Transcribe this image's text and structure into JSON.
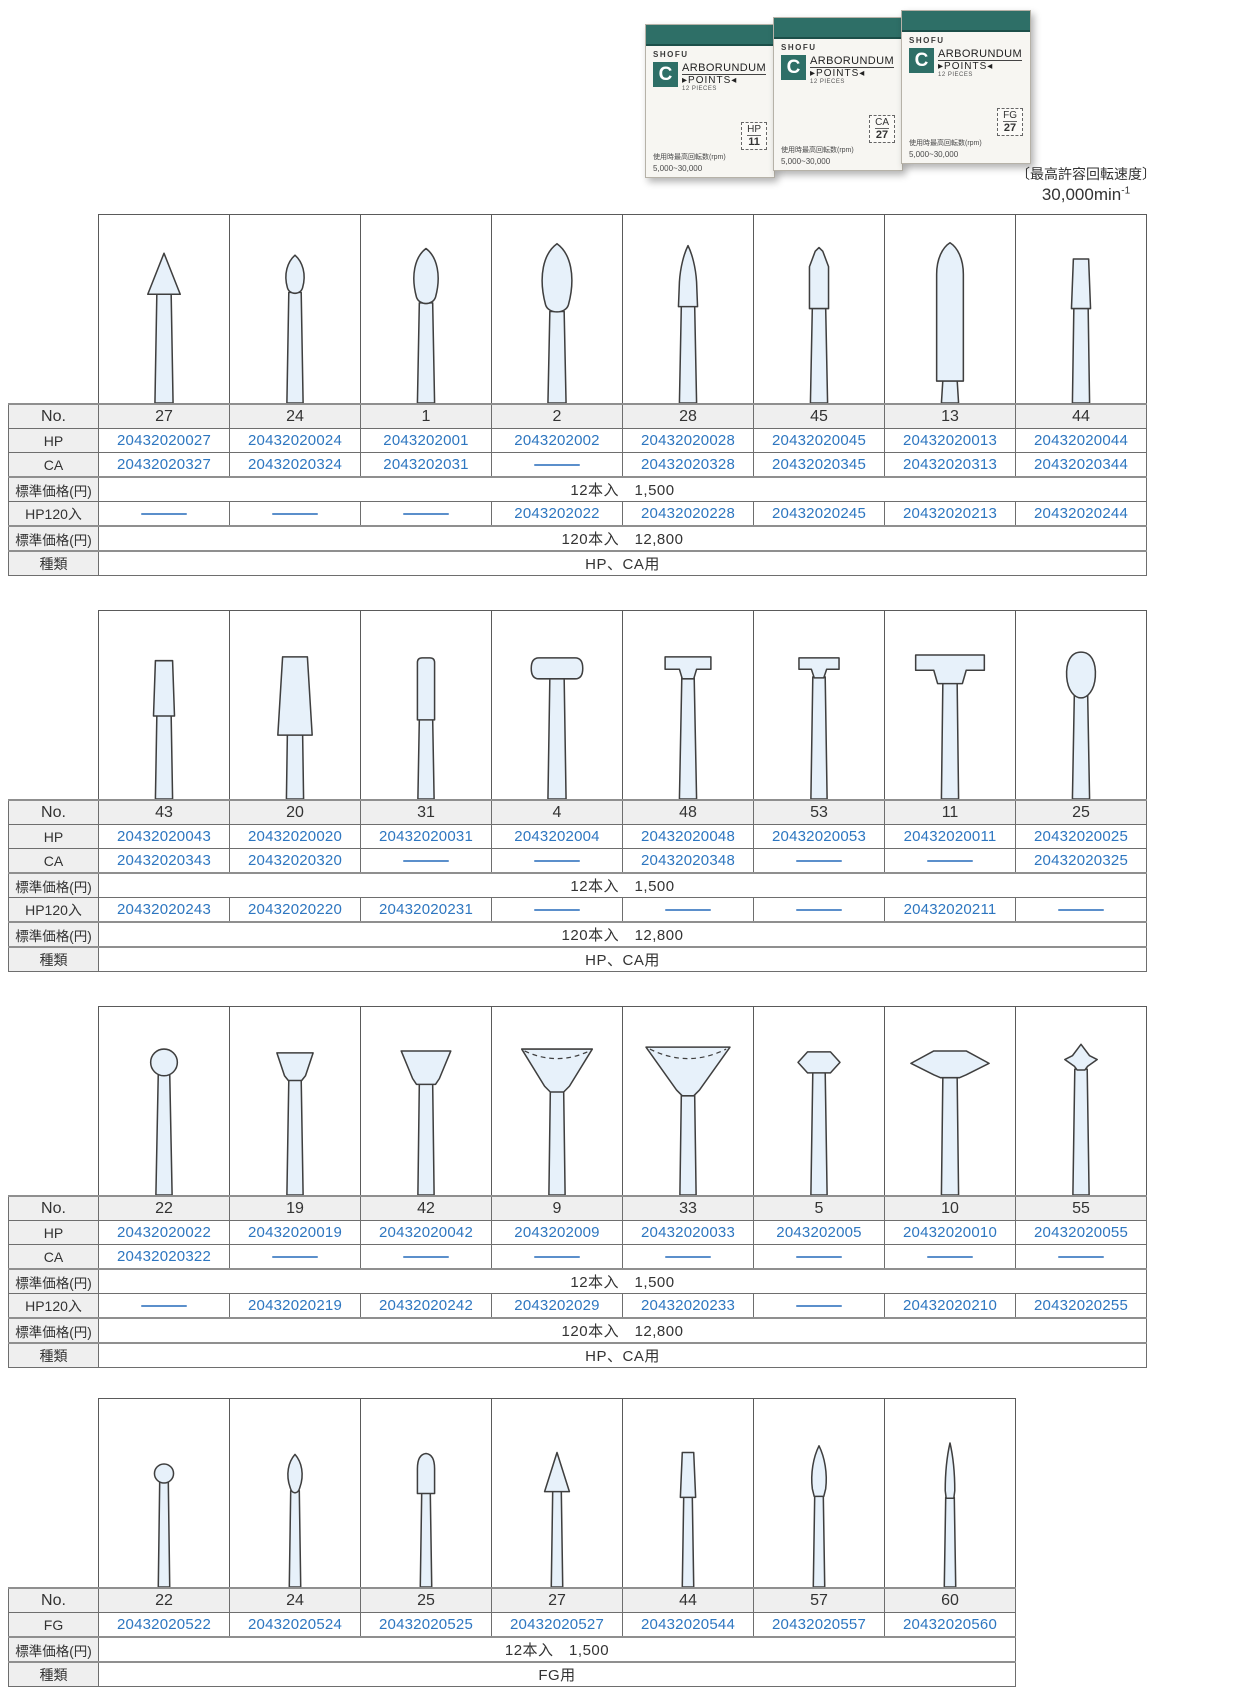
{
  "header": {
    "speed_caption": "〔最高許容回転速度〕",
    "speed_value": "30,000min",
    "speed_exp": "-1"
  },
  "product_boxes": {
    "brand": "SHOFU",
    "logo_letter": "C",
    "title_rest": "ARBORUNDUM",
    "subtitle": "▸POINTS◂",
    "pieces": "12 PIECES",
    "note_line1": "使用時最高回転数(rpm)",
    "note_line2": "5,000~30,000",
    "variants": [
      {
        "type": "HP",
        "no": "11"
      },
      {
        "type": "CA",
        "no": "27"
      },
      {
        "type": "FG",
        "no": "27"
      }
    ]
  },
  "row_labels": {
    "no": "No.",
    "hp": "HP",
    "ca": "CA",
    "fg": "FG",
    "price": "標準価格(円)",
    "hp120": "HP120入",
    "kind": "種類"
  },
  "tables": [
    {
      "kind_value": "HP、CA用",
      "price12": "12本入　1,500",
      "price120": "120本入　12,800",
      "columns": [
        {
          "no": "27",
          "shape": "cone",
          "hp": "20432020027",
          "ca": "20432020327",
          "hp120": null
        },
        {
          "no": "24",
          "shape": "flame-small",
          "hp": "20432020024",
          "ca": "20432020324",
          "hp120": null
        },
        {
          "no": "1",
          "shape": "bud",
          "hp": "2043202001",
          "ca": "2043202031",
          "hp120": null
        },
        {
          "no": "2",
          "shape": "bud-large",
          "hp": "2043202002",
          "ca": null,
          "hp120": "2043202022"
        },
        {
          "no": "28",
          "shape": "taper-point",
          "hp": "20432020028",
          "ca": "20432020328",
          "hp120": "20432020228"
        },
        {
          "no": "45",
          "shape": "bullet",
          "hp": "20432020045",
          "ca": "20432020345",
          "hp120": "20432020245"
        },
        {
          "no": "13",
          "shape": "torpedo",
          "hp": "20432020013",
          "ca": "20432020313",
          "hp120": "20432020213"
        },
        {
          "no": "44",
          "shape": "taper-flat-small",
          "hp": "20432020044",
          "ca": "20432020344",
          "hp120": "20432020244"
        }
      ]
    },
    {
      "kind_value": "HP、CA用",
      "price12": "12本入　1,500",
      "price120": "120本入　12,800",
      "columns": [
        {
          "no": "43",
          "shape": "taper-flat",
          "hp": "20432020043",
          "ca": "20432020343",
          "hp120": "20432020243"
        },
        {
          "no": "20",
          "shape": "taper-flat-large",
          "hp": "20432020020",
          "ca": "20432020320",
          "hp120": "20432020220"
        },
        {
          "no": "31",
          "shape": "cylinder",
          "hp": "20432020031",
          "ca": null,
          "hp120": "20432020231"
        },
        {
          "no": "4",
          "shape": "wheel-round",
          "hp": "2043202004",
          "ca": null,
          "hp120": null
        },
        {
          "no": "48",
          "shape": "tee-flat",
          "hp": "20432020048",
          "ca": "20432020348",
          "hp120": null
        },
        {
          "no": "53",
          "shape": "tee-flat-small",
          "hp": "20432020053",
          "ca": null,
          "hp120": null
        },
        {
          "no": "11",
          "shape": "tee-wide",
          "hp": "20432020011",
          "ca": null,
          "hp120": "20432020211"
        },
        {
          "no": "25",
          "shape": "egg",
          "hp": "20432020025",
          "ca": "20432020325",
          "hp120": null
        }
      ]
    },
    {
      "kind_value": "HP、CA用",
      "price12": "12本入　1,500",
      "price120": "120本入　12,800",
      "columns": [
        {
          "no": "22",
          "shape": "ball",
          "hp": "20432020022",
          "ca": "20432020322",
          "hp120": null
        },
        {
          "no": "19",
          "shape": "cup-small",
          "hp": "20432020019",
          "ca": null,
          "hp120": "20432020219"
        },
        {
          "no": "42",
          "shape": "cup",
          "hp": "20432020042",
          "ca": null,
          "hp120": "20432020242"
        },
        {
          "no": "9",
          "shape": "cup-hollow",
          "hp": "2043202009",
          "ca": null,
          "hp120": "2043202029"
        },
        {
          "no": "33",
          "shape": "cup-hollow-large",
          "hp": "20432020033",
          "ca": null,
          "hp120": "20432020233"
        },
        {
          "no": "5",
          "shape": "knife-hex",
          "hp": "2043202005",
          "ca": null,
          "hp120": null
        },
        {
          "no": "10",
          "shape": "knife-wide",
          "hp": "20432020010",
          "ca": null,
          "hp120": "20432020210"
        },
        {
          "no": "55",
          "shape": "arrow",
          "hp": "20432020055",
          "ca": null,
          "hp120": "20432020255"
        }
      ]
    },
    {
      "kind_value": "FG用",
      "price12": "12本入　1,500",
      "columns": [
        {
          "no": "22",
          "shape": "ball-fg",
          "fg": "20432020522"
        },
        {
          "no": "24",
          "shape": "flame-fg",
          "fg": "20432020524"
        },
        {
          "no": "25",
          "shape": "bullet-round-fg",
          "fg": "20432020525"
        },
        {
          "no": "27",
          "shape": "cone-fg",
          "fg": "20432020527"
        },
        {
          "no": "44",
          "shape": "taper-flat-fg",
          "fg": "20432020544"
        },
        {
          "no": "57",
          "shape": "flame-long-fg",
          "fg": "20432020557"
        },
        {
          "no": "60",
          "shape": "needle-fg",
          "fg": "20432020560"
        }
      ]
    }
  ]
}
